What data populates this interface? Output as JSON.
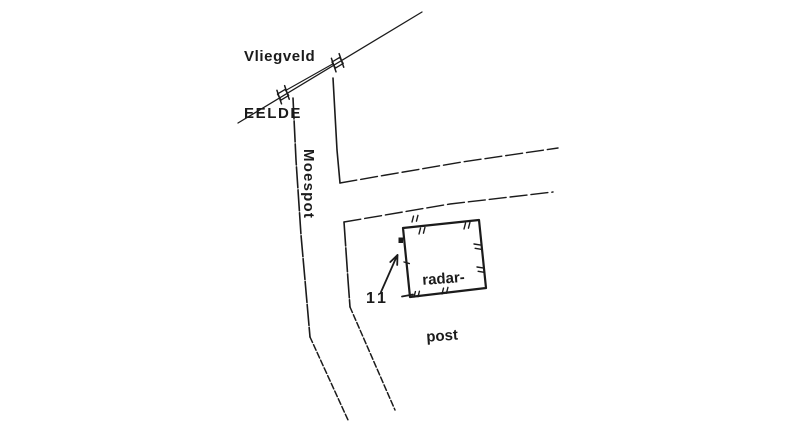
{
  "canvas": {
    "background": "#ffffff",
    "ink": "#1b1b1b"
  },
  "labels": {
    "airfield": {
      "line1": "Vliegveld",
      "line2": "EELDE"
    },
    "road": "Moespot",
    "building": {
      "line1": "radar-",
      "line2": "post"
    },
    "marker": "11"
  },
  "icons": {
    "gates": "level-crossing-gate",
    "ticks": "hatch-mark",
    "arrow": "pointer-arrow",
    "dot": "radar-position-dot"
  }
}
